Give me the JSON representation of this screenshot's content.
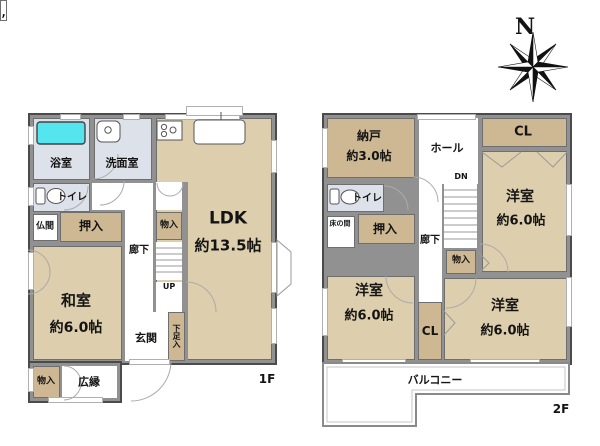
{
  "compass": {
    "north_label": "N"
  },
  "floor1": {
    "label": "1F",
    "bath": "浴室",
    "washroom": "洗面室",
    "toilet": "トイレ",
    "butsuma": "仏間",
    "oshiire": "押入",
    "monoire_hall": "物入",
    "corridor": "廊下",
    "stairs_up": "UP",
    "ldk": "LDK",
    "ldk_size": "約13.5帖",
    "washitsu": "和室",
    "washitsu_size": "約6.0帖",
    "genkan": "玄関",
    "shoe_closet": "下足入",
    "monoire_corner": "物入",
    "hiroen": "広縁"
  },
  "floor2": {
    "label": "2F",
    "nando": "納戸",
    "nando_size": "約3.0帖",
    "hall": "ホール",
    "stairs_down": "DN",
    "closet_top": "CL",
    "bedroom_ne": "洋室",
    "bedroom_ne_size": "約6.0帖",
    "toilet": "トイレ",
    "tokonoma": "床の間",
    "oshiire": "押入",
    "corridor": "廊下",
    "monoire": "物入",
    "bedroom_sw": "洋室",
    "bedroom_sw_size": "約6.0帖",
    "closet_mid": "CL",
    "bedroom_se": "洋室",
    "bedroom_se_size": "約6.0帖",
    "balcony": "バルコニー"
  },
  "colors": {
    "room_tan": "#ddcfad",
    "closet_tan": "#cdb893",
    "wet_area": "#dde1ea",
    "bathtub": "#54e5ee",
    "wall": "#919191"
  }
}
